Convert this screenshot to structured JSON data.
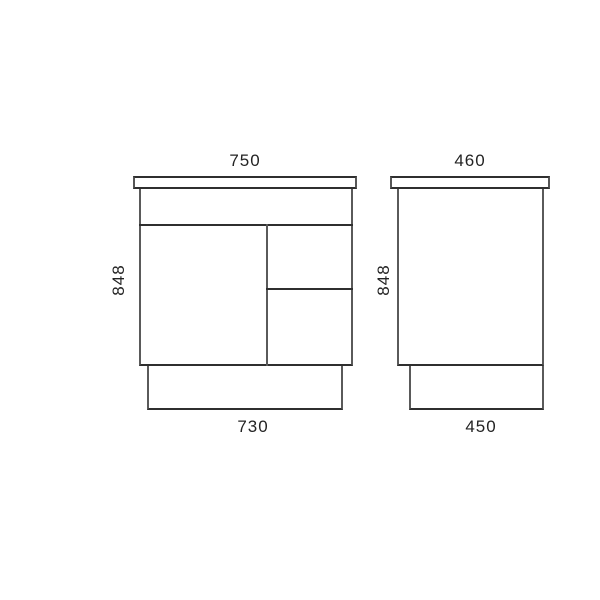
{
  "colors": {
    "background": "#ffffff",
    "line_dark": "#2f2f2f",
    "line_gray": "#5a5a5a",
    "text": "#232323"
  },
  "front_view": {
    "top_width_mm": "750",
    "height_mm": "848",
    "kickboard_width_mm": "730"
  },
  "side_view": {
    "top_depth_mm": "460",
    "height_mm": "848",
    "kickboard_depth_mm": "450"
  }
}
